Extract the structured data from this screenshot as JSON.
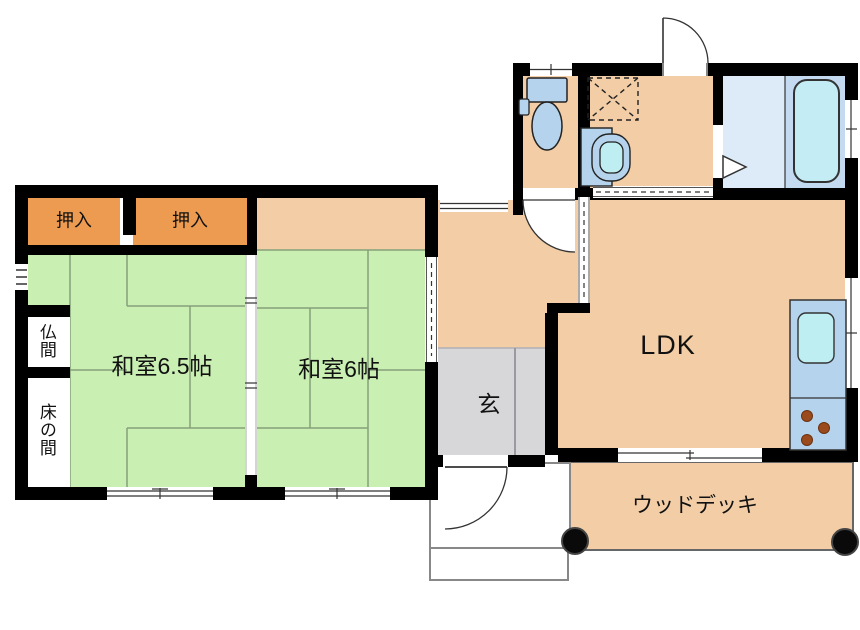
{
  "title": "Japanese house floor plan",
  "labels": {
    "closet_left": "押入",
    "closet_right": "押入",
    "butsuma": "仏間",
    "tokonoma": "床の間",
    "washitsu_6_5": "和室6.5帖",
    "washitsu_6": "和室6帖",
    "genkan": "玄",
    "ldk": "LDK",
    "wood_deck": "ウッドデッキ"
  },
  "fixtures": {
    "toilet": "toilet-icon",
    "vanity": "vanity-sink-icon",
    "washer_pan": "washing-machine-pan-icon",
    "bathtub": "bathtub-icon",
    "kitchen_counter": "kitchen-counter-icon",
    "kitchen_sink": "kitchen-sink-icon",
    "stove": "stove-burners-icon",
    "deck_posts": "deck-post-icon",
    "doors": "door-swing-icon",
    "sliding_doors": "sliding-door-icon",
    "windows": "window-icon"
  },
  "colors": {
    "tatami": "#c9efb3",
    "tatami_line": "#85a179",
    "closet_orange": "#ec9b51",
    "wood_floor": "#f2cda6",
    "genkan_gray": "#d7d7da",
    "bath_wash_area": "#dcebf7",
    "bath_tub_area": "#c3daf0",
    "fixture_blue": "#b5d3ec",
    "fixture_cyan": "#bfeef2",
    "burner_brown": "#9a4a1c",
    "wall": "#000000"
  }
}
